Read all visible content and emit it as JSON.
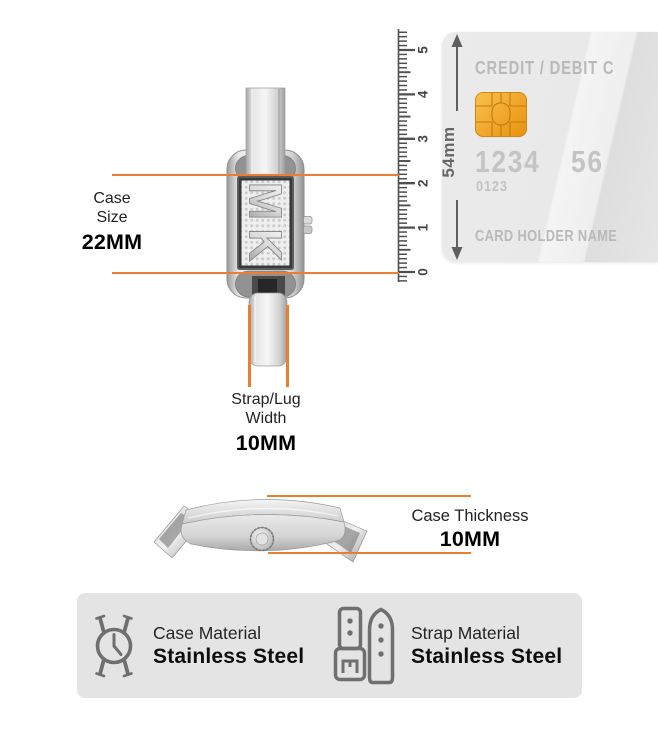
{
  "colors": {
    "accent_orange": "#ED7D31",
    "chip_gold": "#F0A32B",
    "panel_gray": "#E4E4E4",
    "card_gray": "#EAEAEA"
  },
  "case_size": {
    "label_line1": "Case",
    "label_line2": "Size",
    "value": "22MM"
  },
  "strap_lug": {
    "label_line1": "Strap/Lug",
    "label_line2": "Width",
    "value": "10MM"
  },
  "case_thickness": {
    "label": "Case Thickness",
    "value": "10MM"
  },
  "ruler": {
    "tick_labels": [
      "0",
      "1",
      "2",
      "3",
      "4",
      "5"
    ],
    "span_label": "54mm"
  },
  "credit_card": {
    "type_label": "CREDIT / DEBIT C",
    "number_left": "1234",
    "number_right": "56",
    "secondary_number": "0123",
    "holder_label": "CARD HOLDER NAME",
    "chip_icon": "card-chip-icon"
  },
  "materials": {
    "case": {
      "icon": "watch-case-icon",
      "label": "Case Material",
      "value": "Stainless Steel"
    },
    "strap": {
      "icon": "watch-strap-icon",
      "label": "Strap Material",
      "value": "Stainless Steel"
    }
  }
}
